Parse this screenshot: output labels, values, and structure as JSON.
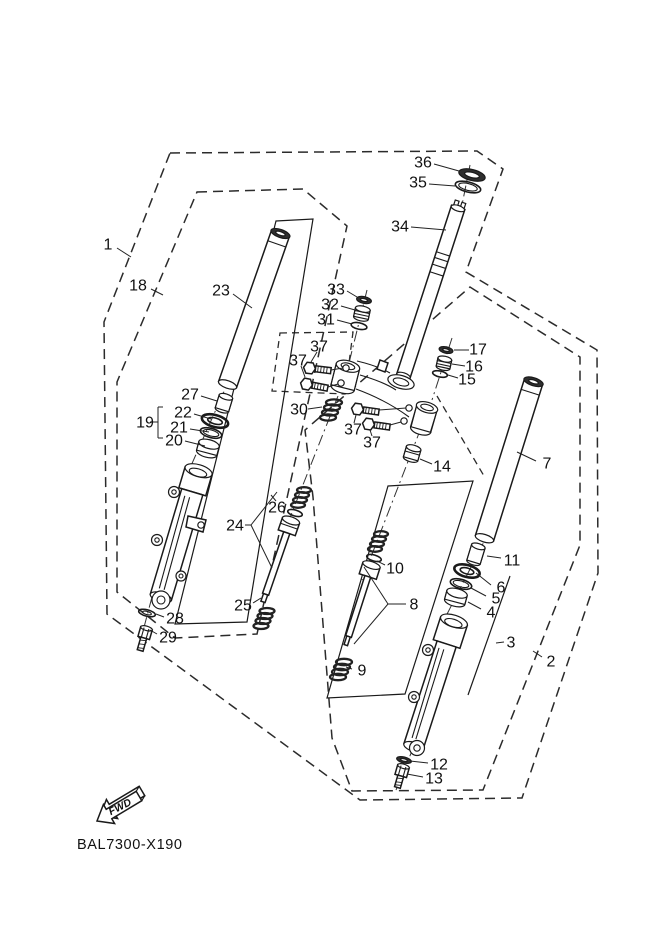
{
  "diagram": {
    "code": "BAL7300-X190",
    "fwd_label": "FWD",
    "colors": {
      "line": "#1a1a1a",
      "background": "#ffffff",
      "label_text": "#111111"
    },
    "part_labels": [
      {
        "n": "1",
        "x": 108,
        "y": 244,
        "leader": [
          117,
          248,
          131,
          257
        ]
      },
      {
        "n": "18",
        "x": 138,
        "y": 285,
        "leader": [
          151,
          289,
          163,
          295
        ]
      },
      {
        "n": "23",
        "x": 221,
        "y": 290,
        "leader": [
          233,
          294,
          252,
          308
        ]
      },
      {
        "n": "27",
        "x": 190,
        "y": 394,
        "leader": [
          201,
          396,
          217,
          401
        ]
      },
      {
        "n": "22",
        "x": 183,
        "y": 412,
        "leader": [
          194,
          414,
          211,
          419
        ]
      },
      {
        "n": "21",
        "x": 179,
        "y": 427,
        "leader": [
          190,
          429,
          209,
          432
        ]
      },
      {
        "n": "20",
        "x": 174,
        "y": 440,
        "leader": [
          185,
          441,
          205,
          446
        ]
      },
      {
        "n": "19",
        "x": 145,
        "y": 422
      },
      {
        "n": "28",
        "x": 175,
        "y": 618,
        "leader": [
          164,
          617,
          156,
          614
        ]
      },
      {
        "n": "29",
        "x": 168,
        "y": 637,
        "leader": [
          157,
          634,
          150,
          630
        ]
      },
      {
        "n": "24",
        "x": 235,
        "y": 525
      },
      {
        "n": "26",
        "x": 277,
        "y": 507,
        "leader": [
          276,
          501,
          271,
          495
        ]
      },
      {
        "n": "25",
        "x": 243,
        "y": 605,
        "leader": [
          253,
          603,
          261,
          598
        ]
      },
      {
        "n": "30",
        "x": 299,
        "y": 409,
        "leader": [
          308,
          409,
          322,
          407
        ]
      },
      {
        "n": "33",
        "x": 336,
        "y": 289,
        "leader": [
          347,
          291,
          357,
          297
        ]
      },
      {
        "n": "32",
        "x": 330,
        "y": 304,
        "leader": [
          341,
          306,
          355,
          310
        ]
      },
      {
        "n": "31",
        "x": 326,
        "y": 319,
        "leader": [
          337,
          320,
          352,
          324
        ]
      },
      {
        "n": "37",
        "x": 319,
        "y": 346,
        "leader": [
          317,
          352,
          311,
          362
        ]
      },
      {
        "n": "37",
        "x": 298,
        "y": 360,
        "leader": [
          301,
          366,
          305,
          377
        ]
      },
      {
        "n": "37",
        "x": 353,
        "y": 429,
        "leader": [
          354,
          423,
          356,
          415
        ]
      },
      {
        "n": "37",
        "x": 372,
        "y": 442,
        "leader": [
          372,
          436,
          370,
          430
        ]
      },
      {
        "n": "34",
        "x": 400,
        "y": 226,
        "leader": [
          411,
          227,
          446,
          230
        ]
      },
      {
        "n": "36",
        "x": 423,
        "y": 162,
        "leader": [
          434,
          164,
          459,
          171
        ]
      },
      {
        "n": "35",
        "x": 418,
        "y": 182,
        "leader": [
          429,
          184,
          455,
          186
        ]
      },
      {
        "n": "17",
        "x": 478,
        "y": 349,
        "leader": [
          469,
          350,
          454,
          350
        ]
      },
      {
        "n": "16",
        "x": 474,
        "y": 366,
        "leader": [
          465,
          366,
          452,
          364
        ]
      },
      {
        "n": "15",
        "x": 467,
        "y": 379,
        "leader": [
          458,
          378,
          448,
          375
        ]
      },
      {
        "n": "14",
        "x": 442,
        "y": 466,
        "leader": [
          432,
          464,
          420,
          459
        ]
      },
      {
        "n": "7",
        "x": 547,
        "y": 463,
        "leader": [
          536,
          461,
          517,
          452
        ]
      },
      {
        "n": "11",
        "x": 512,
        "y": 560,
        "leader": [
          501,
          558,
          487,
          556
        ]
      },
      {
        "n": "6",
        "x": 501,
        "y": 587,
        "leader": [
          491,
          585,
          476,
          573
        ]
      },
      {
        "n": "5",
        "x": 496,
        "y": 598,
        "leader": [
          486,
          596,
          471,
          588
        ]
      },
      {
        "n": "4",
        "x": 491,
        "y": 612,
        "leader": [
          481,
          609,
          468,
          602
        ]
      },
      {
        "n": "3",
        "x": 511,
        "y": 642,
        "leader": [
          504,
          642,
          496,
          643
        ]
      },
      {
        "n": "2",
        "x": 551,
        "y": 661,
        "leader": [
          542,
          657,
          533,
          651
        ]
      },
      {
        "n": "8",
        "x": 414,
        "y": 604
      },
      {
        "n": "10",
        "x": 395,
        "y": 568,
        "leader": [
          385,
          565,
          377,
          561
        ]
      },
      {
        "n": "9",
        "x": 362,
        "y": 670,
        "leader": [
          352,
          669,
          346,
          667
        ]
      },
      {
        "n": "12",
        "x": 439,
        "y": 764,
        "leader": [
          428,
          763,
          410,
          761
        ]
      },
      {
        "n": "13",
        "x": 434,
        "y": 778,
        "leader": [
          423,
          777,
          407,
          774
        ]
      }
    ],
    "bracket_lines": [
      [
        150,
        422,
        158,
        422
      ],
      [
        158,
        407,
        158,
        438
      ],
      [
        158,
        407,
        163,
        407
      ],
      [
        158,
        438,
        163,
        438
      ],
      [
        245,
        525,
        251,
        525
      ],
      [
        251,
        525,
        277,
        492
      ],
      [
        251,
        525,
        272,
        568
      ],
      [
        406,
        604,
        388,
        604
      ],
      [
        388,
        604,
        364,
        567
      ],
      [
        388,
        604,
        354,
        644
      ]
    ]
  }
}
